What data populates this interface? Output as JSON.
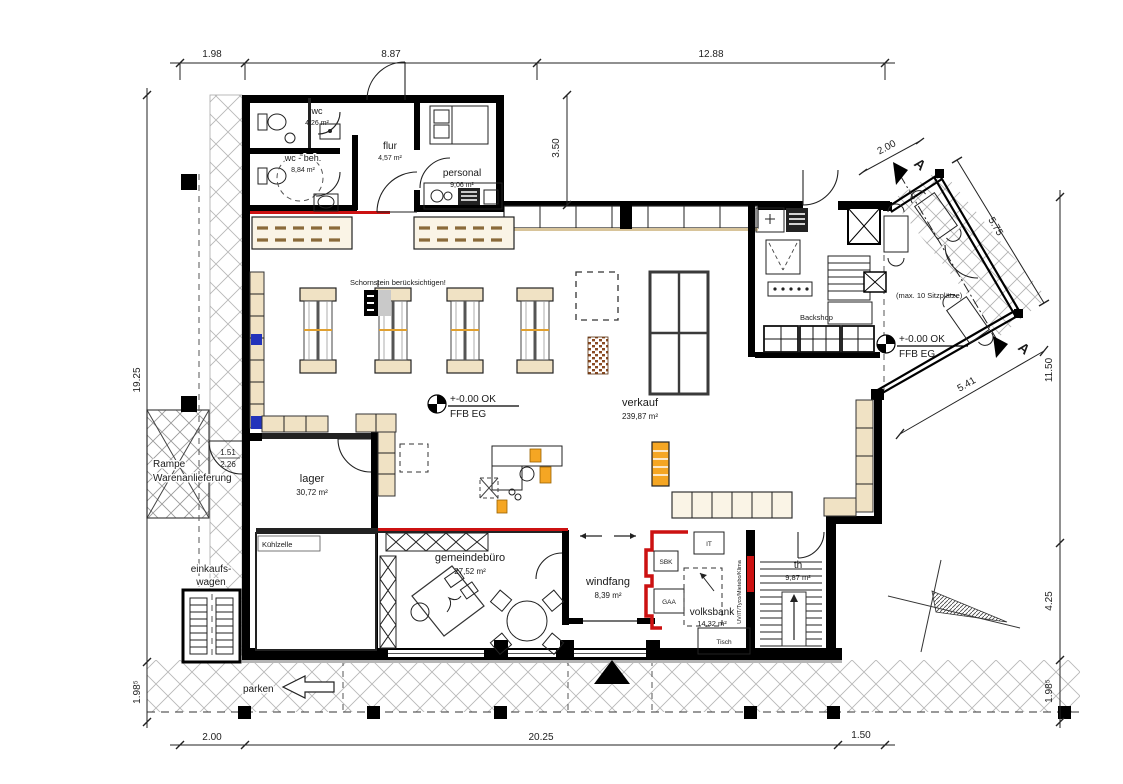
{
  "drawing": {
    "rooms": {
      "wc": {
        "label": "wc",
        "area": "4,26 m²"
      },
      "wc_beh": {
        "label": "wc - beh.",
        "area": "8,84 m²"
      },
      "flur": {
        "label": "flur",
        "area": "4,57 m²"
      },
      "personal": {
        "label": "personal",
        "area": "9,06 m²"
      },
      "verkauf": {
        "label": "verkauf",
        "area": "239,87 m²"
      },
      "lager": {
        "label": "lager",
        "area": "30,72 m²"
      },
      "kuehlzelle": {
        "label": "Kühlzelle"
      },
      "gemeindebuero": {
        "label": "gemeindebüro",
        "area": "27,52 m²"
      },
      "windfang": {
        "label": "windfang",
        "area": "8,39 m²"
      },
      "volksbank": {
        "label": "volksbank",
        "area": "14,32 m²"
      },
      "th": {
        "label": "th",
        "area": "9,87 m²"
      },
      "backshop": {
        "label": "Backshop"
      }
    },
    "labels": {
      "rampe_1": "Rampe",
      "rampe_2": "Warenanlieferung",
      "einkaufswagen_1": "einkaufs-",
      "einkaufswagen_2": "wagen",
      "parken": "parken",
      "schornstein": "Schornstein berücksichtigen!",
      "sitzplaetze": "(max. 10 Sitzplätze)",
      "level_line1": "+-0.00 OK",
      "level_line2": "FFB EG",
      "it": "IT",
      "sbk": "SBK",
      "gaa": "GAA",
      "tisch": "Tisch",
      "technik": "UV/IT/Tyco/Mietebo/Klima",
      "section": "A"
    },
    "dims": {
      "top_left": "1.98",
      "top_mid": "8.87",
      "top_right": "12.88",
      "left_main": "19.25",
      "left_lower": "1.98⁵",
      "bottom_left": "2.00",
      "bottom_mid": "20.25",
      "bottom_right": "1.50",
      "right_upper": "11.50",
      "right_mid": "4.25",
      "right_lower": "1.98⁵",
      "personal_depth": "3.50",
      "terrace": "2.00",
      "wing_upper": "5.75",
      "wing_lower": "5.41",
      "door_width": "1.51",
      "door_height": "2.26"
    },
    "colors": {
      "wall": "#000000",
      "accent_red": "#cc1111",
      "shelf_tan": "#f0e2c4",
      "accent_orange": "#f5a623",
      "hatch_gray": "#b8b8b8",
      "accent_blue": "#2233bb"
    }
  }
}
